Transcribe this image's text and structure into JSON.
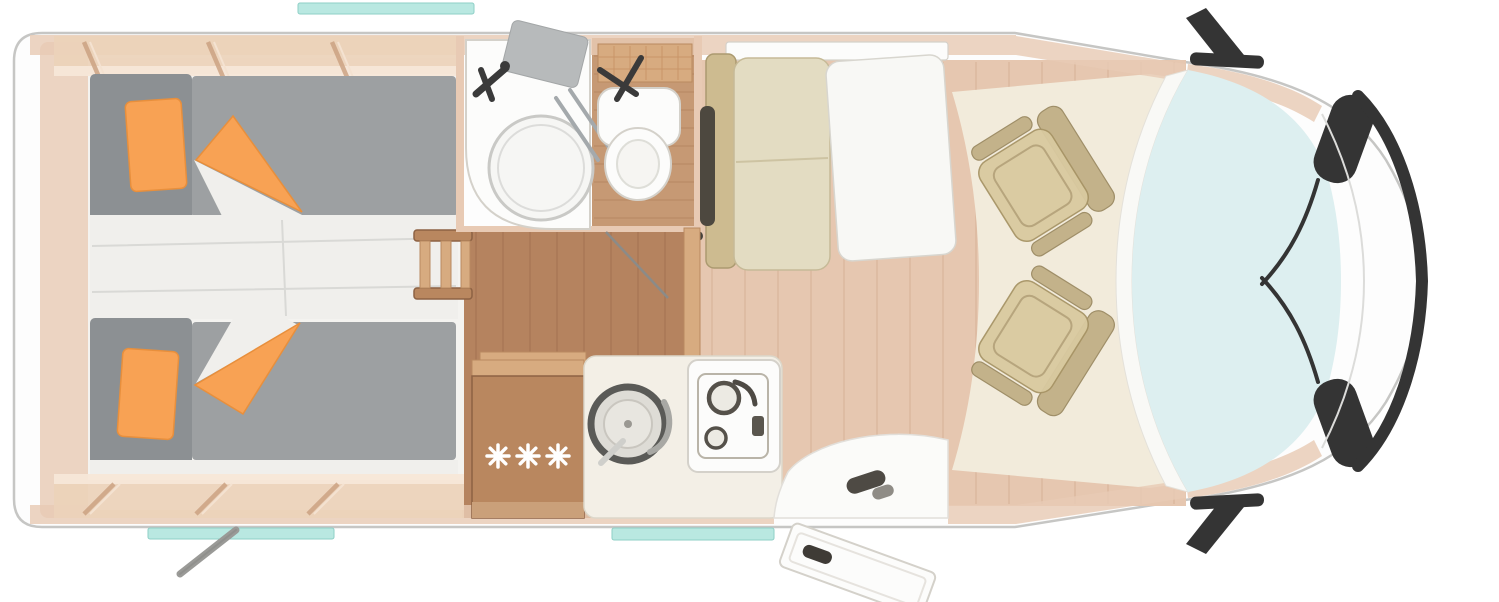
{
  "page": {
    "title": "Motorhome floor plan - top view",
    "background": "#ffffff"
  },
  "palette": {
    "body_fill": "#fdfdfd",
    "body_stroke": "#c6c6c4",
    "wall": "#e8cab4",
    "cabinet": "#ecd2ba",
    "cabinet_edge": "#f7e7d8",
    "cabinet_div": "#c99f7e",
    "wood_floor": "#b5835f",
    "wood_floor_line": "#9c6e4e",
    "wood_light_floor": "#c69974",
    "furniture_wood": "#b9875f",
    "furniture_wood_light": "#d7ab80",
    "mattress": "#9da0a2",
    "headrest": "#8c9093",
    "bed_linen": "#f0efec",
    "bed_base": "#f4f3f0",
    "orange": "#f8a254",
    "orange_deep": "#e88f3c",
    "bench_cushion": "#e3dcc2",
    "bench_frame": "#cdbb90",
    "bench_slot": "#4d483f",
    "seat_khaki": "#d9caa0",
    "seat_khaki_dark": "#c1b086",
    "table_white": "#f8f8f5",
    "dinette_floor": "#e6c7b0",
    "dinette_floor_line": "#d5ae95",
    "cab_floor": "#f2ebdb",
    "glass": "#ddeff0",
    "window_teal": "#b9e8e1",
    "window_teal_edge": "#8ecfc6",
    "dark_trim": "#343434",
    "metal_gray": "#9a9a97",
    "white_fixture": "#fcfcfb",
    "fixture_stroke": "#d4d1ca",
    "shower_mat": "#b7babb",
    "star_white": "#ffffff"
  },
  "floorplan": {
    "vehicle_type": "semi-integrated motorhome, top view",
    "fridge": {
      "freezer_star_count": 3
    },
    "rooms": [
      {
        "name": "rear-bedroom",
        "furniture": [
          "twin-bed-top",
          "twin-bed-bottom",
          "overhead-cabinets",
          "bed-ladder",
          "bed-steps"
        ]
      },
      {
        "name": "bathroom",
        "furniture": [
          "shower",
          "toilet",
          "storage-shelf"
        ]
      },
      {
        "name": "kitchen",
        "furniture": [
          "refrigerator",
          "round-sink",
          "hob",
          "counter"
        ]
      },
      {
        "name": "dinette",
        "furniture": [
          "side-bench",
          "table",
          "swivel-seat-top",
          "swivel-seat-bottom"
        ]
      },
      {
        "name": "cab",
        "furniture": [
          "dashboard",
          "windshield",
          "side-mirrors",
          "wipers"
        ]
      }
    ],
    "exterior_features": [
      "entry-door-open",
      "rear-support-crank",
      "window-top",
      "window-bottom-left",
      "window-bottom-entry"
    ]
  }
}
